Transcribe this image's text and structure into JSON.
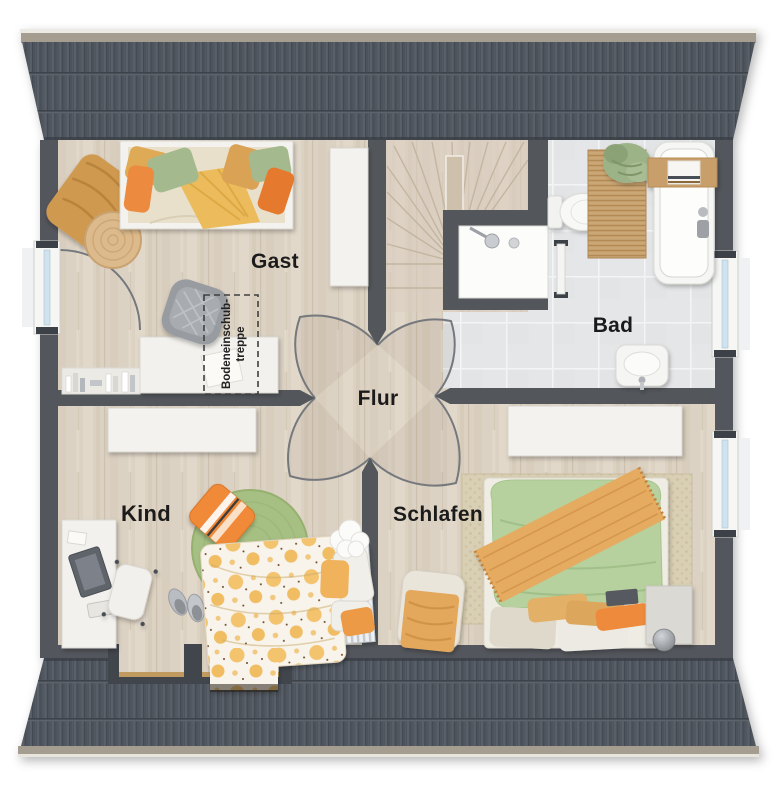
{
  "floorplan": {
    "type": "residential-upper-floor-plan",
    "room_labels": {
      "guest": "Gast",
      "bath": "Bad",
      "hall": "Flur",
      "child": "Kind",
      "bedroom": "Schlafen"
    },
    "annotations": {
      "attic_hatch_line1": "Bodeneinschub-",
      "attic_hatch_line2": "treppe"
    },
    "colors": {
      "roof_tiles": "#4d535b",
      "walls": "#53575b",
      "wood_floor": "#dcd2c3",
      "bath_tile_floor": "#e4e6e8",
      "ridge_trim": "#a59e90",
      "accent_orange": "#ec8b3f",
      "accent_mustard": "#ecbc5c",
      "accent_sage": "#a4ba8e",
      "duvet_green": "#b6d19e",
      "rug_green": "#a6bf82",
      "jute_mat": "#c5a06e",
      "white_furniture": "#f3f2ee"
    }
  }
}
